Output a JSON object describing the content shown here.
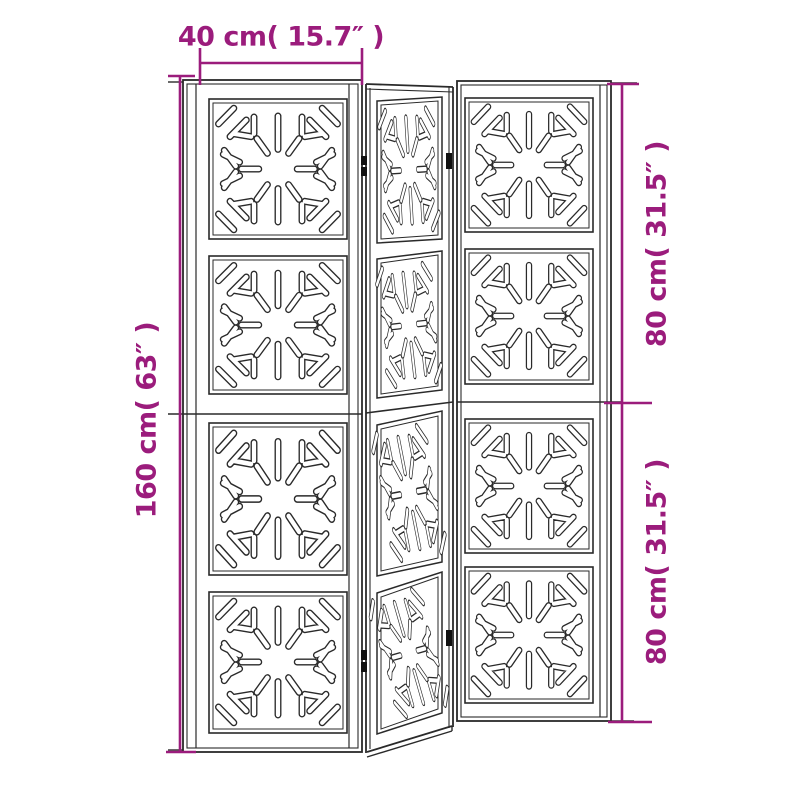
{
  "diagram": {
    "title": "Room divider 3-panel dimension diagram",
    "panel_count": 3
  },
  "dimension_labels": {
    "width": "40 cm( 15.7″ )",
    "height": "160 cm( 63″ )",
    "panel_top": "80 cm( 31.5″ )",
    "panel_bottom": "80 cm( 31.5″ )"
  },
  "colors": {
    "dimension": "#9B1C7C",
    "line": "#2a2a2a",
    "background": "#ffffff"
  }
}
